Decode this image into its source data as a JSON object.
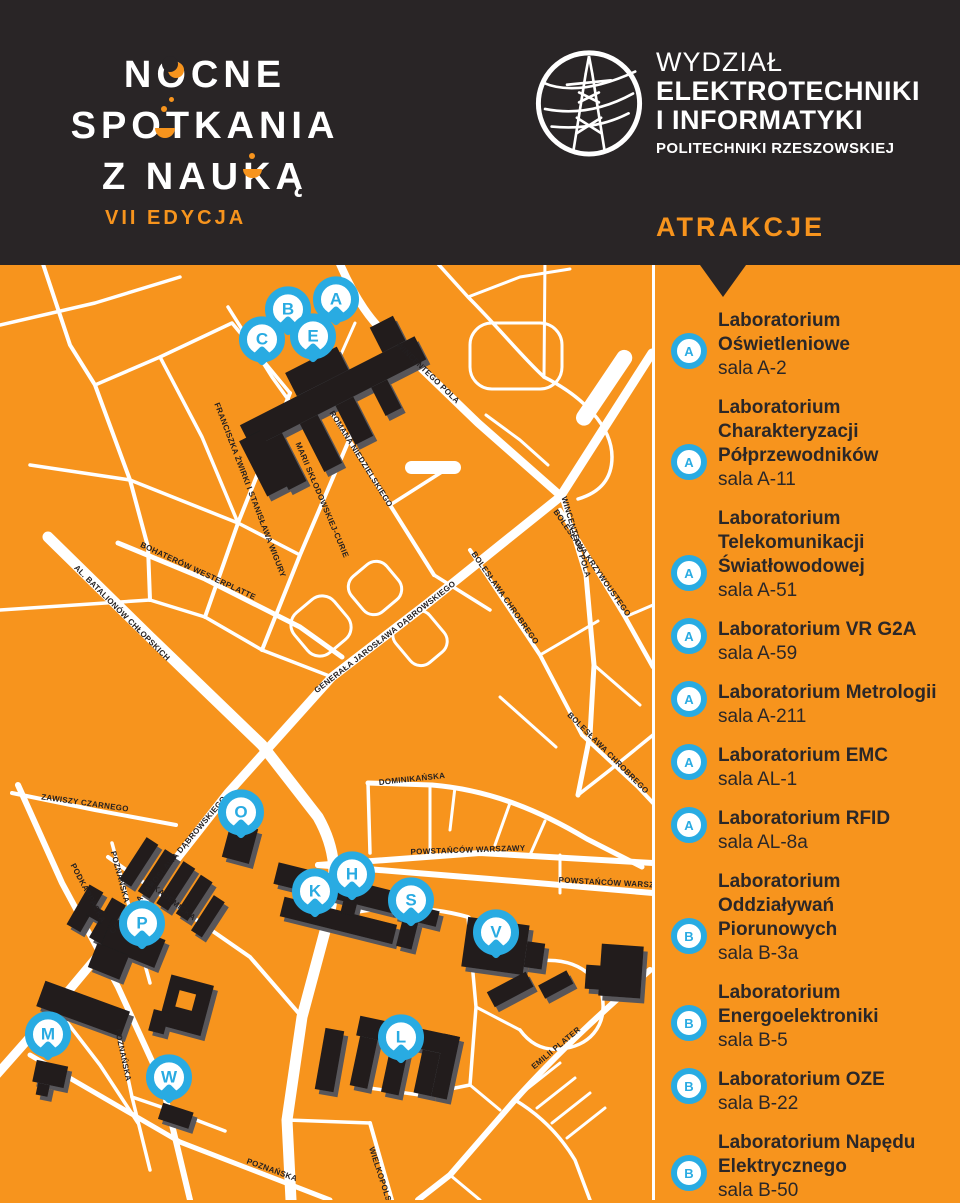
{
  "colors": {
    "orange": "#F7941D",
    "dark": "#292526",
    "blue": "#29ABE2",
    "white": "#FFFFFF",
    "building": "#201D1E"
  },
  "header": {
    "event_logo": {
      "line1": "NOCNE",
      "line2": "SPOTKANIA",
      "line3": "Z NAUKĄ",
      "edition": "VII EDYCJA"
    },
    "faculty_logo": {
      "line1": "WYDZIAŁ",
      "line2": "ELEKTROTECHNIKI",
      "line3": "I INFORMATYKI",
      "line4": "POLITECHNIKI RZESZOWSKIEJ"
    }
  },
  "sidebar": {
    "heading": "ATRAKCJE",
    "items": [
      {
        "marker": "A",
        "title": "Laboratorium Oświetleniowe",
        "room": "sala A-2"
      },
      {
        "marker": "A",
        "title": "Laboratorium Charakteryzacji Półprzewodników",
        "room": "sala A-11"
      },
      {
        "marker": "A",
        "title": "Laboratorium Telekomunikacji Światłowodowej",
        "room": "sala A-51"
      },
      {
        "marker": "A",
        "title": "Laboratorium VR G2A",
        "room": "sala A-59"
      },
      {
        "marker": "A",
        "title": "Laboratorium Metrologii",
        "room": "sala A-211"
      },
      {
        "marker": "A",
        "title": "Laboratorium EMC",
        "room": "sala AL-1"
      },
      {
        "marker": "A",
        "title": "Laboratorium RFID",
        "room": "sala AL-8a"
      },
      {
        "marker": "B",
        "title": "Laboratorium Oddziaływań Piorunowych",
        "room": "sala B-3a"
      },
      {
        "marker": "B",
        "title": "Laboratorium Energoelektroniki",
        "room": "sala B-5"
      },
      {
        "marker": "B",
        "title": "Laboratorium OZE",
        "room": "sala B-22"
      },
      {
        "marker": "B",
        "title": "Laboratorium Napędu Elektrycznego",
        "room": "sala B-50"
      }
    ]
  },
  "map": {
    "markers": [
      {
        "letter": "A",
        "x": 336,
        "y": 38
      },
      {
        "letter": "B",
        "x": 288,
        "y": 48
      },
      {
        "letter": "C",
        "x": 262,
        "y": 78
      },
      {
        "letter": "E",
        "x": 313,
        "y": 75
      },
      {
        "letter": "O",
        "x": 241,
        "y": 551
      },
      {
        "letter": "P",
        "x": 142,
        "y": 662
      },
      {
        "letter": "K",
        "x": 315,
        "y": 630
      },
      {
        "letter": "H",
        "x": 352,
        "y": 613
      },
      {
        "letter": "S",
        "x": 411,
        "y": 639
      },
      {
        "letter": "V",
        "x": 496,
        "y": 671
      },
      {
        "letter": "M",
        "x": 48,
        "y": 773
      },
      {
        "letter": "W",
        "x": 169,
        "y": 816
      },
      {
        "letter": "L",
        "x": 401,
        "y": 776
      }
    ],
    "street_labels": [
      {
        "text": "WINCENTEGO POLA",
        "x": 428,
        "y": 108,
        "a": 44
      },
      {
        "text": "WINCENTEGO POLA",
        "x": 576,
        "y": 272,
        "a": 73
      },
      {
        "text": "ROMANA NIEDZIELSKIEGO",
        "x": 361,
        "y": 194,
        "a": 58
      },
      {
        "text": "FRANCISZKA ŻWIRKI I STANISŁAWA WIGURY",
        "x": 250,
        "y": 225,
        "a": 69
      },
      {
        "text": "MARII SKŁODOWSKIEJ-CURIE",
        "x": 322,
        "y": 235,
        "a": 67
      },
      {
        "text": "GENERAŁA JAROSŁAWA DĄBROWSKIEGO",
        "x": 385,
        "y": 372,
        "a": -38
      },
      {
        "text": "GENERAŁA JAROSŁAWA DĄBROWSKIEGO",
        "x": 168,
        "y": 600,
        "a": -50
      },
      {
        "text": "AL. BATALIONÓW CHŁOPSKICH",
        "x": 122,
        "y": 348,
        "a": 45
      },
      {
        "text": "BOHATERÓW WESTERPLATTE",
        "x": 198,
        "y": 306,
        "a": 25
      },
      {
        "text": "ZAWISZY CZARNEGO",
        "x": 85,
        "y": 538,
        "a": 8
      },
      {
        "text": "PODKARPACKA",
        "x": 88,
        "y": 628,
        "a": 62
      },
      {
        "text": "AKADEMICKA",
        "x": 172,
        "y": 636,
        "a": 38
      },
      {
        "text": "POZNAŃSKA",
        "x": 120,
        "y": 612,
        "a": 75
      },
      {
        "text": "POZNAŃSKA",
        "x": 123,
        "y": 790,
        "a": 78
      },
      {
        "text": "POZNAŃSKA",
        "x": 272,
        "y": 905,
        "a": 20
      },
      {
        "text": "WIELKOPOLSKA",
        "x": 382,
        "y": 915,
        "a": 72
      },
      {
        "text": "POWSTAŃCÓW WARSZAWY",
        "x": 468,
        "y": 585,
        "a": -2
      },
      {
        "text": "POWSTAŃCÓW WARSZAWY",
        "x": 616,
        "y": 618,
        "a": 3
      },
      {
        "text": "DOMINIKAŃSKA",
        "x": 412,
        "y": 514,
        "a": -6
      },
      {
        "text": "BOLESŁAWA CHROBREGO",
        "x": 505,
        "y": 333,
        "a": 55
      },
      {
        "text": "BOLESŁAWA KRZYWOUSTEGO",
        "x": 592,
        "y": 298,
        "a": 55
      },
      {
        "text": "BOLESŁAWA CHROBREGO",
        "x": 608,
        "y": 488,
        "a": 45
      },
      {
        "text": "EMILII PLATER",
        "x": 556,
        "y": 783,
        "a": -40
      }
    ]
  }
}
